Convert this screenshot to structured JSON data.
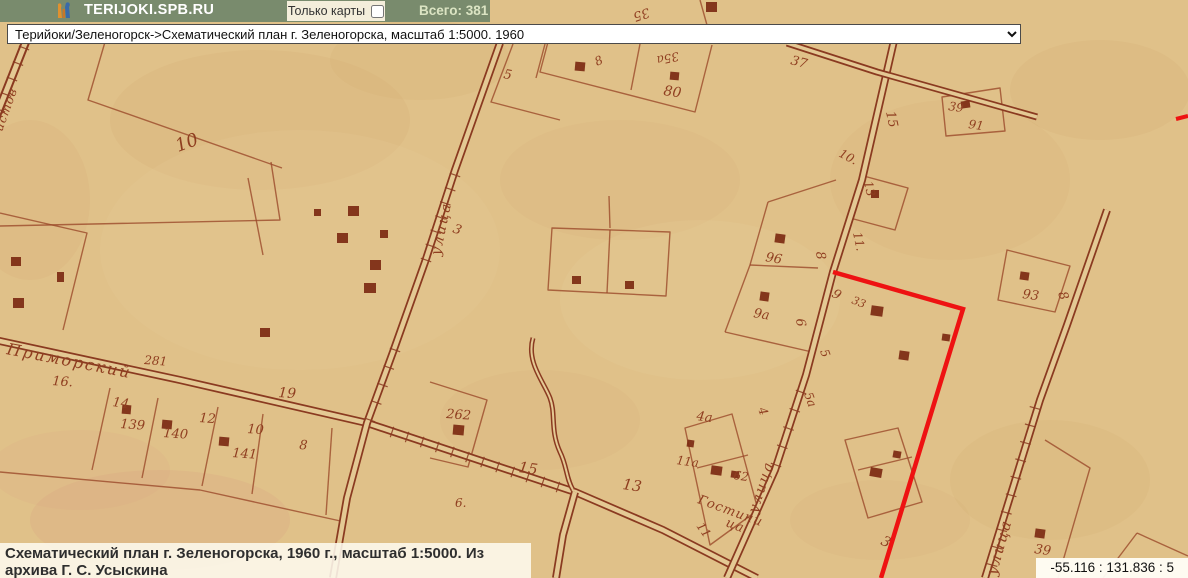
{
  "header": {
    "site": "TERIJOKI.SPB.RU",
    "filter_label": "Только карты",
    "total_label": "Всего: 381"
  },
  "icons": {
    "logo": "torch-logo",
    "dropdown": "chevron-down"
  },
  "selector": {
    "value": "Терийоки/Зеленогорск->Схематический план г. Зеленогорска, масштаб 1:5000. 1960"
  },
  "caption": {
    "text": "Схематический план г. Зеленогорска, 1960 г., масштаб 1:5000. Из архива Г. С. Усыскина"
  },
  "statusbar": {
    "coordinates": "-55.116 : 131.836 : 5"
  },
  "map": {
    "colors": {
      "bg": "#e0c189",
      "roadfill": "#e4c994",
      "ink": "#8a3a20",
      "parcel": "#9b4a2b",
      "building": "#7c2a12",
      "label": "#8f3e20",
      "highlight": "#ee1212"
    },
    "stains": [
      [
        260,
        120,
        150,
        70,
        "#c89058",
        0.1
      ],
      [
        620,
        180,
        120,
        60,
        "#cf9c64",
        0.08
      ],
      [
        160,
        520,
        130,
        50,
        "#d4907e",
        0.15
      ],
      [
        80,
        470,
        90,
        40,
        "#d4907e",
        0.1
      ],
      [
        950,
        180,
        120,
        80,
        "#cb985f",
        0.08
      ],
      [
        1100,
        90,
        90,
        50,
        "#c8935a",
        0.1
      ],
      [
        420,
        60,
        90,
        40,
        "#cb965e",
        0.09
      ],
      [
        700,
        300,
        140,
        80,
        "#e9d3a2",
        0.18
      ],
      [
        540,
        420,
        100,
        50,
        "#cf9b62",
        0.08
      ],
      [
        1050,
        480,
        100,
        60,
        "#cc975e",
        0.09
      ],
      [
        300,
        250,
        200,
        120,
        "#e8d0a0",
        0.15
      ],
      [
        880,
        520,
        90,
        40,
        "#d29a66",
        0.08
      ],
      [
        30,
        200,
        60,
        80,
        "#c78f57",
        0.08
      ]
    ],
    "roads": [
      {
        "d": "M 28,36 L -6,122",
        "outer": 9,
        "inner": 5
      },
      {
        "d": "M -5,340 L 180,380 L 367,423 L 575,492 L 663,530 L 757,578",
        "outer": 8,
        "inner": 4.5
      },
      {
        "d": "M 500,43 L 455,170 L 425,262 L 393,352 L 367,423 L 347,498 L 333,578",
        "outer": 8,
        "inner": 4.5
      },
      {
        "d": "M 897,28 L 893,45 L 862,180 L 833,272 L 806,375 L 775,470 L 727,578",
        "outer": 8,
        "inner": 4.5
      },
      {
        "d": "M 787,43 L 877,72 L 1037,117",
        "outer": 7,
        "inner": 3.5
      },
      {
        "d": "M 1107,210 L 1067,325 L 1040,400 L 985,578",
        "outer": 8,
        "inner": 4.5
      },
      {
        "d": "M 575,492 L 563,535 L 556,578",
        "outer": 8,
        "inner": 4.5
      },
      {
        "d": "M 533,338 C 526,362 544,382 550,398 C 556,414 550,430 560,452 C 567,466 566,478 573,490",
        "outer": 5,
        "inner": 2
      }
    ],
    "ticks": [
      [
        392,
        432,
        558,
        487,
        12
      ],
      [
        455,
        175,
        426,
        260,
        7
      ],
      [
        395,
        350,
        370,
        420,
        5
      ],
      [
        24,
        48,
        0,
        110,
        5
      ],
      [
        1035,
        408,
        992,
        565,
        10
      ],
      [
        801,
        392,
        776,
        465,
        5
      ]
    ],
    "parcels": [
      "M 0,213 L 87,233 L 63,330",
      "M 0,226 L 280,220 L 271,162",
      "M 105,42 L 88,100 L 282,168",
      "M 248,178 L 263,255",
      "M 513,44 L 491,102 L 560,120",
      "M 545,44 L 536,78",
      "M 548,42 L 540,72 L 695,112 L 712,45",
      "M 640,44 L 631,90",
      "M 700,0 L 712,43",
      "M 942,97 L 1000,88 L 1005,131 L 946,136 Z",
      "M 1007,250 L 1070,266 L 1055,312 L 998,300 Z",
      "M 768,202 L 836,180",
      "M 768,202 L 750,265 L 725,332",
      "M 750,265 L 818,268",
      "M 725,332 L 812,352",
      "M 552,228 L 670,232 L 666,296 L 548,290 Z",
      "M 610,230 L 607,293",
      "M 609,196 L 610,228",
      "M 430,382 L 487,400 L 468,467 L 430,458",
      "M 685,428 L 732,414 L 758,510 L 710,545 Z",
      "M 697,468 L 748,455",
      "M 0,472 L 200,490 L 345,522",
      "M 110,388 L 92,470",
      "M 158,398 L 142,478",
      "M 218,407 L 202,486",
      "M 263,414 L 252,494",
      "M 332,428 L 326,515",
      "M 860,175 L 908,188 L 895,230 L 850,218",
      "M 845,440 L 898,428 L 922,502 L 868,518 Z",
      "M 858,470 L 912,457",
      "M 1045,440 L 1090,468 L 1058,578",
      "M 1137,533 L 1103,578",
      "M 1137,533 L 1188,556"
    ],
    "buildings": [
      [
        2,
        12,
        11,
        10,
        0
      ],
      [
        575,
        62,
        10,
        9,
        5
      ],
      [
        670,
        72,
        9,
        8,
        5
      ],
      [
        706,
        2,
        11,
        10,
        0
      ],
      [
        961,
        101,
        9,
        7,
        -8
      ],
      [
        871,
        190,
        8,
        8,
        0
      ],
      [
        314,
        209,
        7,
        7,
        0
      ],
      [
        348,
        206,
        11,
        10,
        0
      ],
      [
        337,
        233,
        11,
        10,
        0
      ],
      [
        380,
        230,
        8,
        8,
        0
      ],
      [
        370,
        260,
        11,
        10,
        0
      ],
      [
        364,
        283,
        12,
        10,
        0
      ],
      [
        260,
        328,
        10,
        9,
        0
      ],
      [
        11,
        257,
        10,
        9,
        0
      ],
      [
        57,
        272,
        7,
        10,
        0
      ],
      [
        13,
        298,
        11,
        10,
        0
      ],
      [
        775,
        234,
        10,
        9,
        8
      ],
      [
        760,
        292,
        9,
        9,
        8
      ],
      [
        871,
        306,
        12,
        10,
        8
      ],
      [
        899,
        351,
        10,
        9,
        8
      ],
      [
        942,
        334,
        8,
        7,
        8
      ],
      [
        1020,
        272,
        9,
        8,
        8
      ],
      [
        572,
        276,
        9,
        8,
        0
      ],
      [
        625,
        281,
        9,
        8,
        0
      ],
      [
        122,
        405,
        9,
        9,
        5
      ],
      [
        162,
        420,
        10,
        9,
        5
      ],
      [
        219,
        437,
        10,
        9,
        5
      ],
      [
        687,
        440,
        7,
        7,
        8
      ],
      [
        711,
        466,
        11,
        9,
        8
      ],
      [
        731,
        471,
        8,
        7,
        8
      ],
      [
        453,
        425,
        11,
        10,
        5
      ],
      [
        1035,
        529,
        10,
        9,
        8
      ],
      [
        893,
        451,
        8,
        7,
        10
      ],
      [
        870,
        468,
        12,
        9,
        10
      ]
    ],
    "labels": [
      {
        "t": "10",
        "x": 178,
        "y": 152,
        "rot": -20,
        "fs": 18
      },
      {
        "t": "5",
        "x": 503,
        "y": 78,
        "rot": 10,
        "fs": 13
      },
      {
        "t": "8",
        "x": 597,
        "y": 66,
        "rot": -25,
        "fs": 12
      },
      {
        "t": "35а",
        "x": 678,
        "y": 52,
        "rot": 168,
        "fs": 12
      },
      {
        "t": "80",
        "x": 663,
        "y": 95,
        "rot": 8,
        "fs": 14
      },
      {
        "t": "35",
        "x": 648,
        "y": 8,
        "rot": 162,
        "fs": 13
      },
      {
        "t": "37",
        "x": 790,
        "y": 64,
        "rot": 15,
        "fs": 13
      },
      {
        "t": "39",
        "x": 948,
        "y": 110,
        "rot": 8,
        "fs": 12
      },
      {
        "t": "91",
        "x": 968,
        "y": 128,
        "rot": 8,
        "fs": 12
      },
      {
        "t": "15",
        "x": 886,
        "y": 112,
        "rot": 78,
        "fs": 13
      },
      {
        "t": "10.",
        "x": 838,
        "y": 156,
        "rot": 28,
        "fs": 12
      },
      {
        "t": "13",
        "x": 864,
        "y": 182,
        "rot": 78,
        "fs": 12
      },
      {
        "t": "11.",
        "x": 853,
        "y": 233,
        "rot": 78,
        "fs": 12
      },
      {
        "t": "96",
        "x": 765,
        "y": 261,
        "rot": 10,
        "fs": 13
      },
      {
        "t": "8",
        "x": 816,
        "y": 252,
        "rot": 82,
        "fs": 13
      },
      {
        "t": "9а",
        "x": 753,
        "y": 317,
        "rot": 10,
        "fs": 13
      },
      {
        "t": "6",
        "x": 796,
        "y": 319,
        "rot": 82,
        "fs": 13
      },
      {
        "t": "9",
        "x": 831,
        "y": 296,
        "rot": 30,
        "fs": 13
      },
      {
        "t": "33",
        "x": 851,
        "y": 303,
        "rot": 22,
        "fs": 11
      },
      {
        "t": "5",
        "x": 820,
        "y": 351,
        "rot": 70,
        "fs": 12
      },
      {
        "t": "5а",
        "x": 804,
        "y": 394,
        "rot": 70,
        "fs": 12
      },
      {
        "t": "4",
        "x": 758,
        "y": 409,
        "rot": 70,
        "fs": 12
      },
      {
        "t": "93",
        "x": 1022,
        "y": 298,
        "rot": 8,
        "fs": 13
      },
      {
        "t": "8",
        "x": 1058,
        "y": 293,
        "rot": 72,
        "fs": 13
      },
      {
        "t": "39",
        "x": 1034,
        "y": 553,
        "rot": 8,
        "fs": 13
      },
      {
        "t": "4а",
        "x": 696,
        "y": 420,
        "rot": 8,
        "fs": 13
      },
      {
        "t": "11а",
        "x": 676,
        "y": 464,
        "rot": 8,
        "fs": 12
      },
      {
        "t": "62",
        "x": 733,
        "y": 479,
        "rot": 8,
        "fs": 12
      },
      {
        "t": "11",
        "x": 696,
        "y": 526,
        "rot": 55,
        "fs": 12
      },
      {
        "t": "15",
        "x": 518,
        "y": 472,
        "rot": 8,
        "fs": 15
      },
      {
        "t": "13",
        "x": 622,
        "y": 489,
        "rot": 8,
        "fs": 15
      },
      {
        "t": "262",
        "x": 446,
        "y": 418,
        "rot": 4,
        "fs": 13
      },
      {
        "t": "6.",
        "x": 455,
        "y": 507,
        "rot": 0,
        "fs": 12
      },
      {
        "t": "16.",
        "x": 52,
        "y": 385,
        "rot": 4,
        "fs": 13
      },
      {
        "t": "14",
        "x": 112,
        "y": 406,
        "rot": 8,
        "fs": 13
      },
      {
        "t": "139",
        "x": 120,
        "y": 428,
        "rot": 4,
        "fs": 13
      },
      {
        "t": "140",
        "x": 163,
        "y": 437,
        "rot": 4,
        "fs": 13
      },
      {
        "t": "12",
        "x": 199,
        "y": 422,
        "rot": 4,
        "fs": 13
      },
      {
        "t": "10",
        "x": 247,
        "y": 433,
        "rot": 4,
        "fs": 13
      },
      {
        "t": "141",
        "x": 232,
        "y": 457,
        "rot": 4,
        "fs": 13
      },
      {
        "t": "8",
        "x": 299,
        "y": 449,
        "rot": 4,
        "fs": 13
      },
      {
        "t": "19",
        "x": 278,
        "y": 397,
        "rot": 4,
        "fs": 14
      },
      {
        "t": "281",
        "x": 144,
        "y": 364,
        "rot": 4,
        "fs": 12
      },
      {
        "t": "3",
        "x": 452,
        "y": 232,
        "rot": 20,
        "fs": 13
      },
      {
        "t": "3",
        "x": 880,
        "y": 544,
        "rot": 25,
        "fs": 14
      }
    ],
    "street_names": [
      {
        "t": "Приморский",
        "x": 6,
        "y": 354,
        "rot": 11,
        "fs": 16,
        "ls": 2
      },
      {
        "t": "улица",
        "x": 440,
        "y": 256,
        "rot": -78,
        "fs": 14,
        "ls": 2
      },
      {
        "t": "улица",
        "x": 757,
        "y": 514,
        "rot": -72,
        "fs": 14,
        "ls": 2
      },
      {
        "t": "улица",
        "x": 996,
        "y": 576,
        "rot": -74,
        "fs": 15,
        "ls": 2
      },
      {
        "t": "истов",
        "x": 2,
        "y": 132,
        "rot": -70,
        "fs": 12,
        "ls": 1
      },
      {
        "t": "Гостини",
        "x": 697,
        "y": 503,
        "rot": 20,
        "fs": 13,
        "ls": 1
      },
      {
        "t": "ца",
        "x": 725,
        "y": 526,
        "rot": 20,
        "fs": 13,
        "ls": 1
      }
    ],
    "highlights": [
      {
        "d": "M 833,272 L 963,309 L 926,430 L 881,578",
        "w": 4.5
      },
      {
        "d": "M 1176,119 L 1188,116",
        "w": 4
      }
    ]
  }
}
